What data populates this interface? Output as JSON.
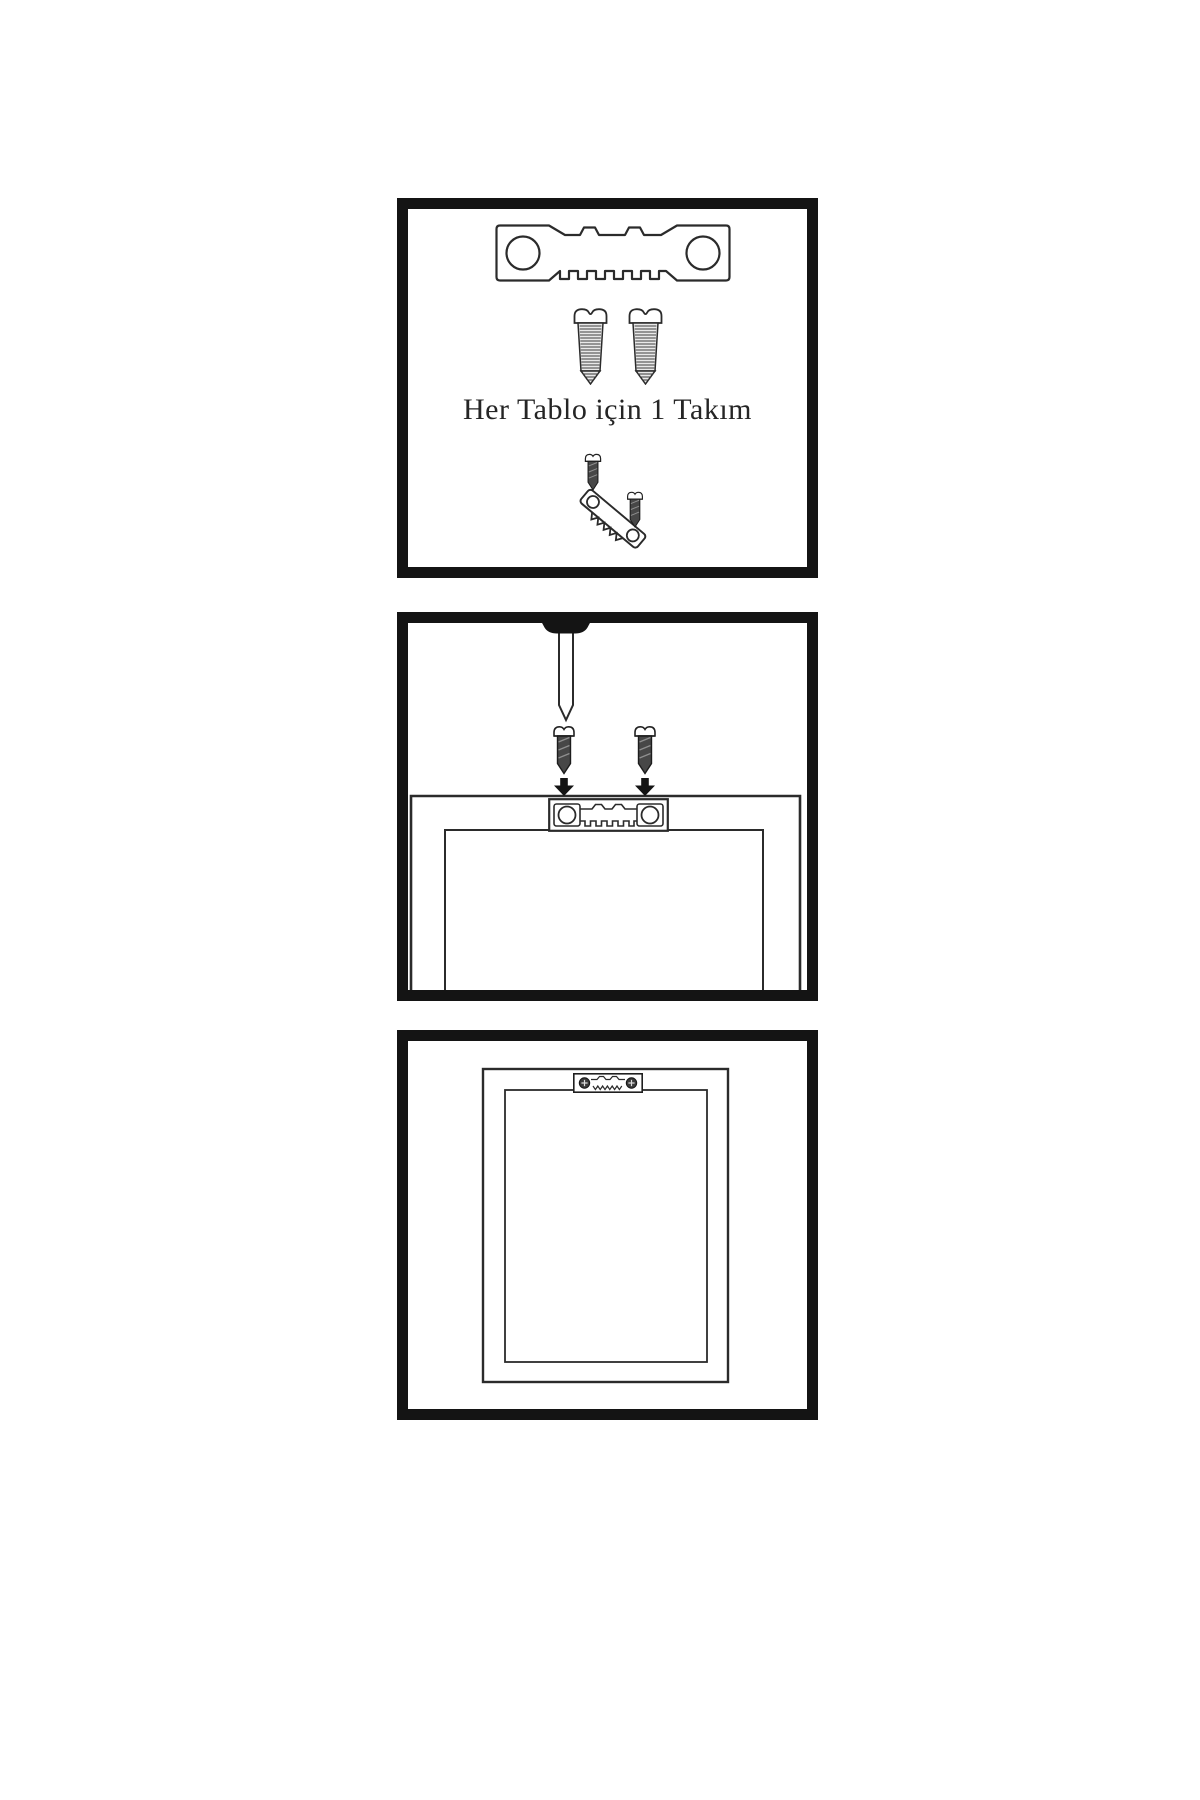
{
  "colors": {
    "background": "#ffffff",
    "ink": "#2b2b2b",
    "panel_border": "#141414",
    "screw_dark_fill": "#474747"
  },
  "step1": {
    "caption": "Her Tablo için 1 Takım",
    "parts": [
      "sawtooth-hanger",
      "screw",
      "screw",
      "tilted-hanger-with-screws"
    ]
  },
  "step2": {
    "parts": [
      "screwdriver",
      "dark-screw",
      "dark-screw",
      "down-arrow",
      "down-arrow",
      "frame-back",
      "mounted-sawtooth-hanger"
    ]
  },
  "step3": {
    "parts": [
      "frame-back",
      "mounted-sawtooth-hanger-with-screws"
    ]
  }
}
